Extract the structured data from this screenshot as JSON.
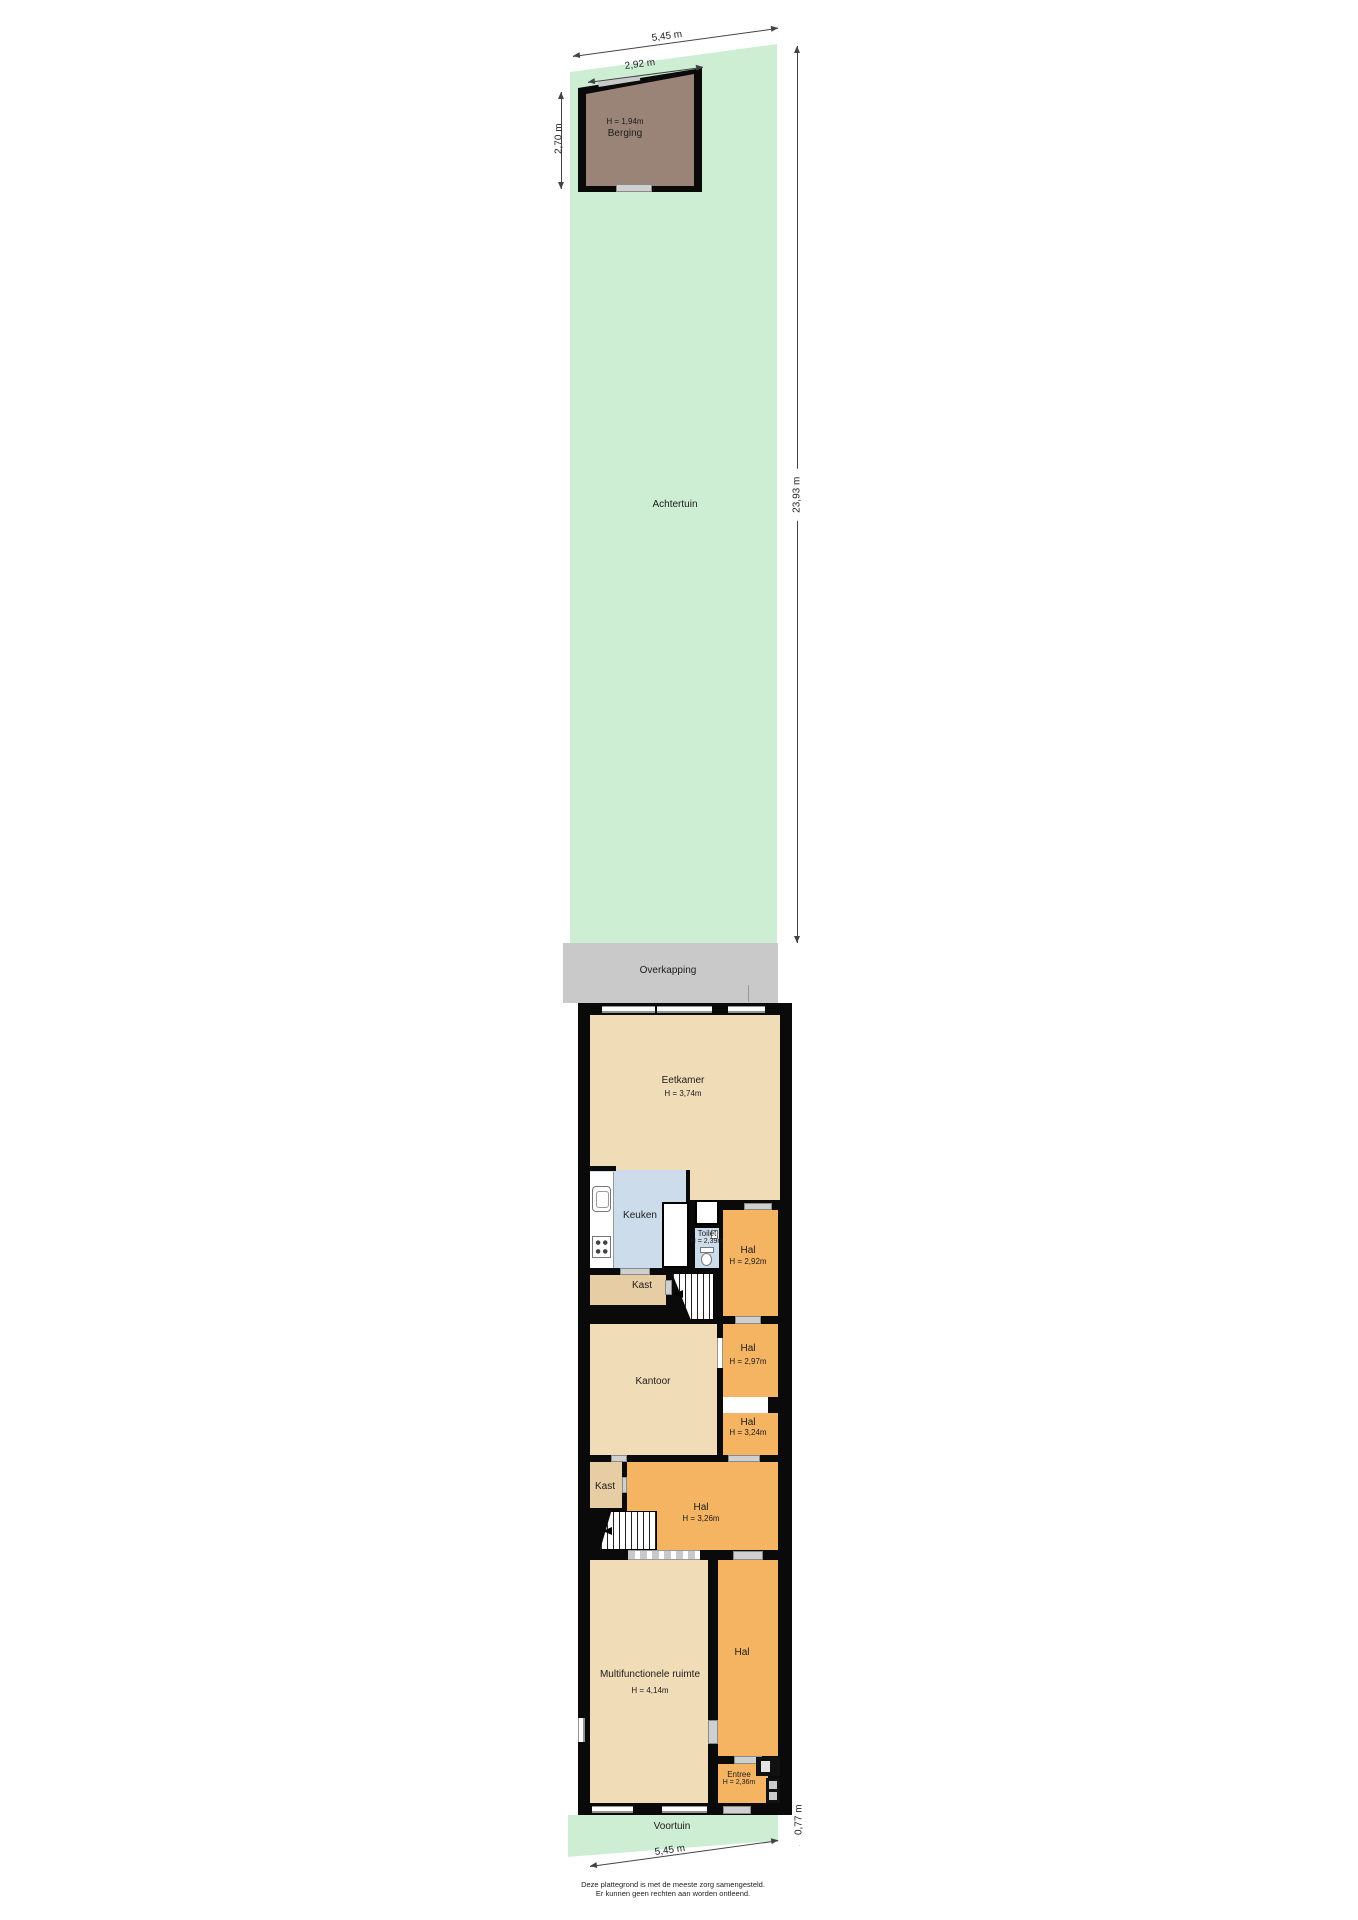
{
  "labels": {
    "achtertuin": "Achtertuin",
    "voortuin": "Voortuin",
    "overkapping": "Overkapping",
    "berging": "Berging",
    "berging_h": "H = 1,94m",
    "eetkamer": "Eetkamer",
    "eetkamer_h": "H = 3,74m",
    "keuken": "Keuken",
    "toilet": "Toilet",
    "toilet_h": "H = 2,39m",
    "hal_rear": "Hal",
    "hal_rear_h": "H = 2,92m",
    "kast_kitchen": "Kast",
    "kantoor": "Kantoor",
    "hal_mid1": "Hal",
    "hal_mid1_h": "H = 2,97m",
    "hal_mid2": "Hal",
    "hal_mid2_h": "H = 3,24m",
    "kast_hall": "Kast",
    "hal_stairs": "Hal",
    "hal_stairs_h": "H = 3,26m",
    "multifunctionele": "Multifunctionele ruimte",
    "multifunctionele_h": "H = 4,14m",
    "hal_front": "Hal",
    "entree": "Entree",
    "entree_h": "H = 2,36m"
  },
  "dimensions": {
    "plot_width_top": "5,45 m",
    "berging_width": "2,92 m",
    "berging_depth": "2,70 m",
    "achtertuin_depth": "23,93 m",
    "voortuin_depth": "0,77 m",
    "plot_width_bottom": "5,45 m"
  },
  "footer": {
    "line1": "Deze plattegrond is met de meeste zorg samengesteld.",
    "line2": "Er kunnen geen rechten aan worden ontleend."
  },
  "colors": {
    "garden": "#cdeed3",
    "room_tan": "#f0ddb8",
    "room_orange": "#f4b462",
    "room_blue": "#cddceb",
    "closet_tan": "#e6cda4",
    "shed_brown": "#9a8478",
    "overkapping_gray": "#c9c9c9",
    "wall": "#0a0a0a"
  }
}
